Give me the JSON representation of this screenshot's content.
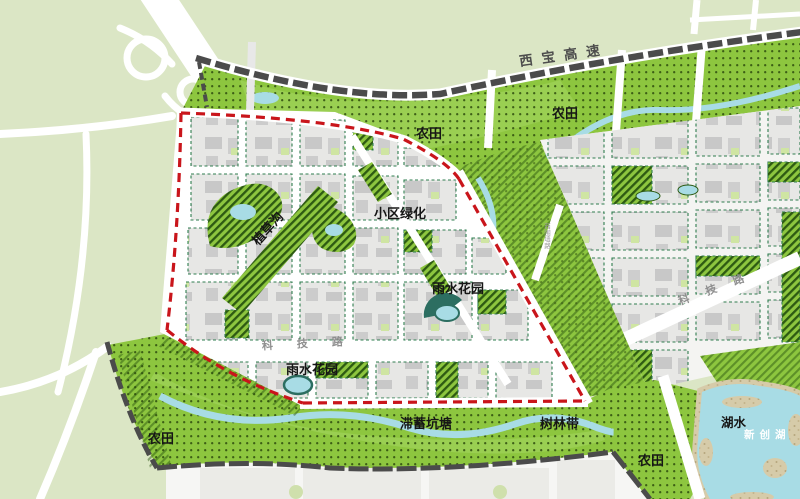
{
  "map": {
    "region_labels": {
      "farmland_top_center": "农田",
      "farmland_top_right": "农田",
      "farmland_bottom_left": "农田",
      "farmland_bottom_right": "农田",
      "residential_greening": "小区绿化",
      "grass_swale": "植草沟",
      "rain_garden_upper": "雨水花园",
      "rain_garden_lower": "雨水花园",
      "detention_pond": "滞蓄坑塘",
      "tree_belt": "树林带",
      "lake_water": "湖水",
      "lake_name": "新创湖"
    },
    "road_labels": {
      "expressway": "西宝高速",
      "tech_road_mid": "科技路",
      "tech_road_east": "科技路",
      "minor_road_vertical": "西围墙路"
    },
    "colors": {
      "site_boundary_red": "#c9151b",
      "farmland_green": "#8dc63f",
      "hatch_dark_green": "#2d5a12",
      "pale_land_green": "#dbe6c5",
      "water_blue": "#a8dce5",
      "lake_shore_tan": "#d6cba9",
      "expressway_dark": "#4b4b4b",
      "road_label_gray": "#8f8f8f",
      "block_gray": "#e7e7e5",
      "building_gray": "#c8c8c8",
      "block_outline_green": "#2f7d4f",
      "rain_garden_teal": "#2c6e61"
    }
  }
}
